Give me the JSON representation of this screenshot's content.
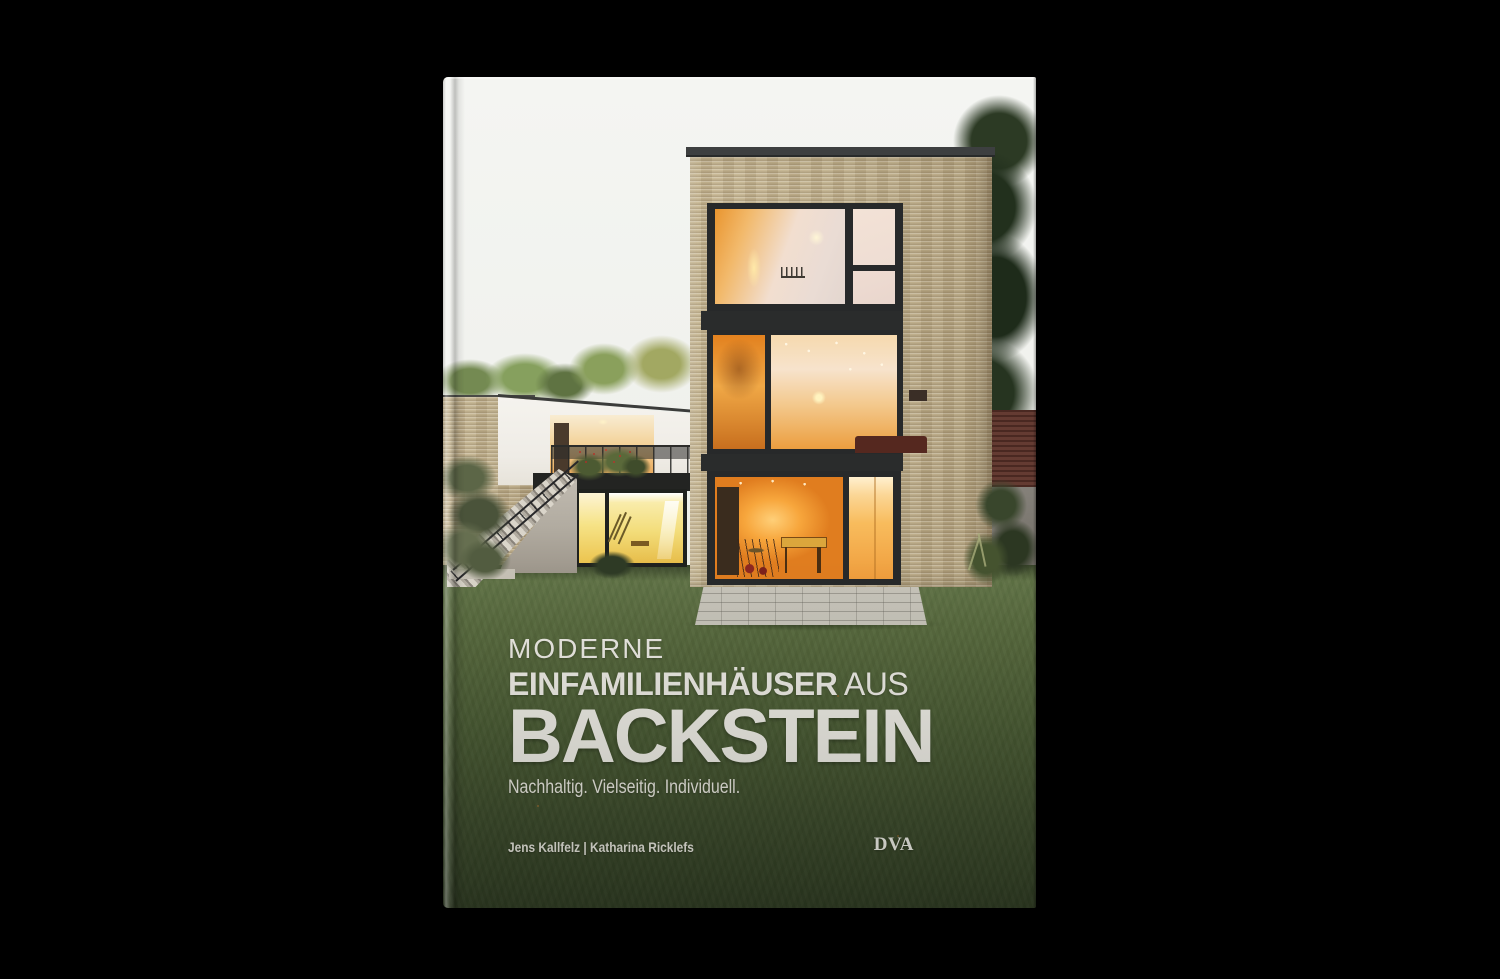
{
  "book": {
    "title_line1": "MODERNE",
    "title_line2_strong": "EINFAMILIENHÄUSER",
    "title_line2_light": " AUS",
    "title_line3": "BACKSTEIN",
    "subtitle": "Nachhaltig. Vielseitig. Individuell.",
    "authors": "Jens Kallfelz | Katharina Ricklefs",
    "publisher": "DVA"
  },
  "colors": {
    "page_background": "#000000",
    "sky": "#f3f4f1",
    "brick_facade": "#c2b18d",
    "roof_coping": "#3d3f40",
    "window_glow": "#f29a36",
    "basement_glow": "#f3dd7a",
    "lawn_top": "#64774a",
    "lawn_bottom": "#2f3b23",
    "title_text": "#eceae4"
  },
  "cover_photo_alt": "Modern flat-roofed single-family brick house at dusk with warmly lit floor-to-ceiling windows, terrace with plants, exterior concrete staircase and large lawn"
}
